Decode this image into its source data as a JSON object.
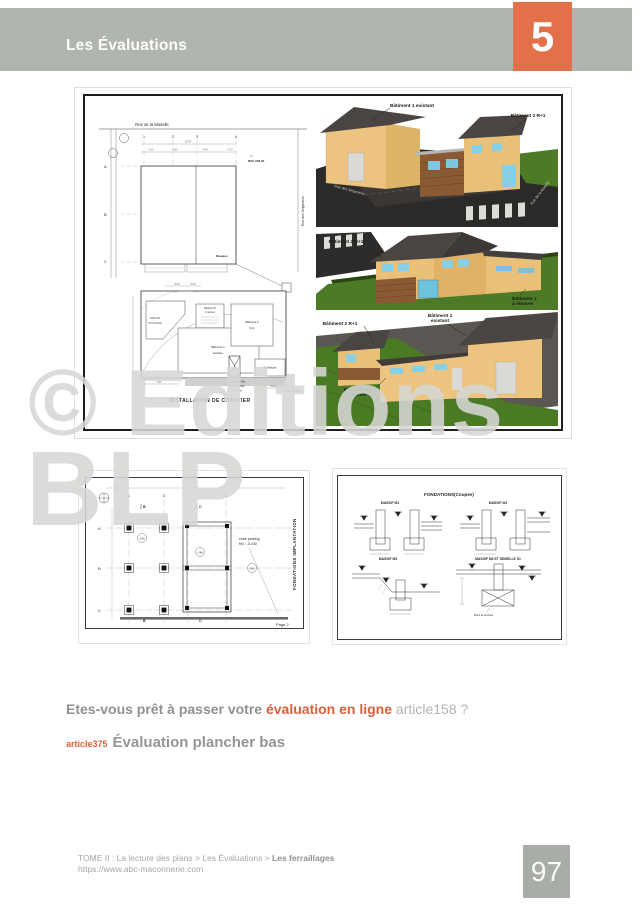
{
  "header": {
    "title": "Les Évaluations",
    "chapter_number": "5"
  },
  "watermark": {
    "line1": "© Editions",
    "line2": "BLP"
  },
  "figure_top": {
    "site_plan": {
      "street_top": "Rue de la Moselle",
      "street_right": "Rue des Singerains",
      "grid_cols": [
        "1",
        "2",
        "3",
        "4"
      ],
      "grid_rows": [
        "A",
        "B",
        "C"
      ],
      "dim_total": "19.97",
      "dims": [
        "3.10",
        "4.90",
        "4.90",
        "4.23"
      ],
      "level_label": "Tn",
      "level_value": "NGF 206.00",
      "reseaux": "Réseaux"
    },
    "chantier": {
      "caption": "INSTALLATION DE CHANTIER",
      "stockage_l1": "AIRE DE",
      "stockage_l2": "STOCKAGE",
      "bat_a_l1": "Bâtiment A",
      "bat_a_l2": "R+1",
      "bat_b_l1": "Bâtiment B",
      "bat_b_l2": "à rénover",
      "bat_c_l1": "Bâtiment C",
      "bat_c_l2": "Existant",
      "prefab": "Préfabriqués",
      "crane_l1": "Grue GMR 36m",
      "crane_l2": "Flèche 28.00m",
      "crane_l3": "17.620 m",
      "access": "Accès Chantier",
      "dim_left": "4.00",
      "dim_right": "6.00",
      "dim_top1": "5.00",
      "dim_top2": "3.00"
    },
    "render1": {
      "label_left": "Bâtiment 1 existant",
      "label_right": "Bâtiment 2 R+1",
      "street_left": "Rue des Singerains",
      "street_right": "Rue de la Moselle"
    },
    "render2": {
      "label_left": "Bâtiment 2 R+1",
      "label_right_l1": "Bâtiment 3",
      "label_right_l2": "à rénover"
    },
    "render3": {
      "label_left": "Bâtiment 2 R+1",
      "label_center_l1": "Bâtiment 1",
      "label_center_l2": "existant",
      "label_bottom_l1": "Bâtiment 3",
      "label_bottom_l2": "à rénover"
    }
  },
  "implantation": {
    "side_title": "FONDATIONS IMPLANTATION",
    "grid_cols": [
      "1",
      "2",
      "3",
      "4"
    ],
    "grid_rows": [
      "A",
      "B",
      "C"
    ],
    "note_l1": "zone parking",
    "note_l2": "fini : -0.240",
    "levels": [
      "-0.45",
      "-0.86",
      "-0.46"
    ],
    "marker_b": "B",
    "marker_c": "C",
    "page_ref": "Page 2"
  },
  "coupes": {
    "title": "FONDATIONS(Coupes)",
    "captions": [
      "MASSIF M1",
      "MASSIF M2",
      "MASSIF M3",
      "MASSIF M4 ET SEMELLE S1"
    ],
    "note": "Béton de propreté"
  },
  "question": {
    "prefix": "Etes-vous prêt à passer votre ",
    "highlight": "évaluation en ligne",
    "suffix": " article158 ?"
  },
  "section": {
    "ref": "article375",
    "title": "Évaluation plancher bas"
  },
  "footer": {
    "breadcrumb_prefix": "TOME II : La lecture des plans > Les Évaluations > ",
    "breadcrumb_bold": "Les ferraillages",
    "url": "https://www.abc-maconnerie.com",
    "page_number": "97"
  }
}
